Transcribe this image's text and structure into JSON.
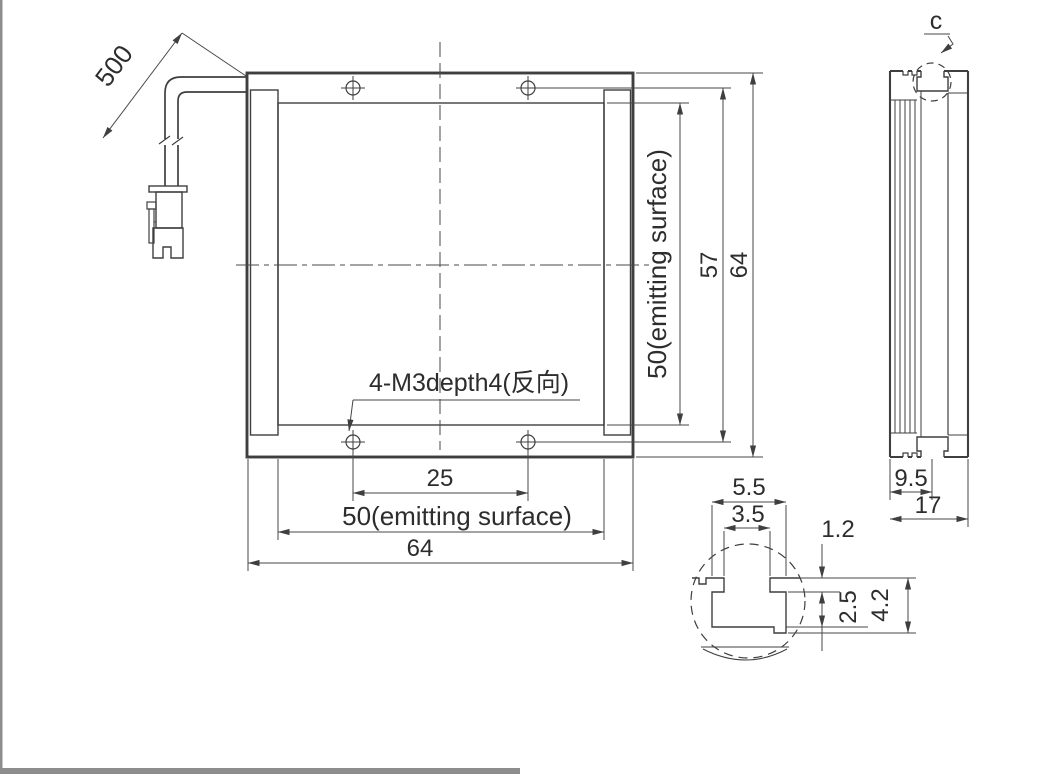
{
  "front_view": {
    "cable_dim": "500",
    "hole_note": "4-M3depth4(反向)",
    "dim_hole_spacing_x": "25",
    "dim_emitting_bottom": "50(emitting surface)",
    "dim_overall_bottom": "64",
    "dim_emitting_right": "50(emitting surface)",
    "dim_hole_spacing_y": "57",
    "dim_overall_right": "64"
  },
  "side_view": {
    "detail_label": "c",
    "dim_slot_offset": "9.5",
    "dim_thickness": "17"
  },
  "detail_c": {
    "dim_outer_width": "5.5",
    "dim_inner_width": "3.5",
    "dim_lip_thickness": "1.2",
    "dim_inner_depth": "2.5",
    "dim_total_depth": "4.2"
  },
  "colors": {
    "line": "#3f3f3f",
    "text": "#2d2d2d",
    "page_edge": "#8d8d8d",
    "background": "#ffffff"
  }
}
